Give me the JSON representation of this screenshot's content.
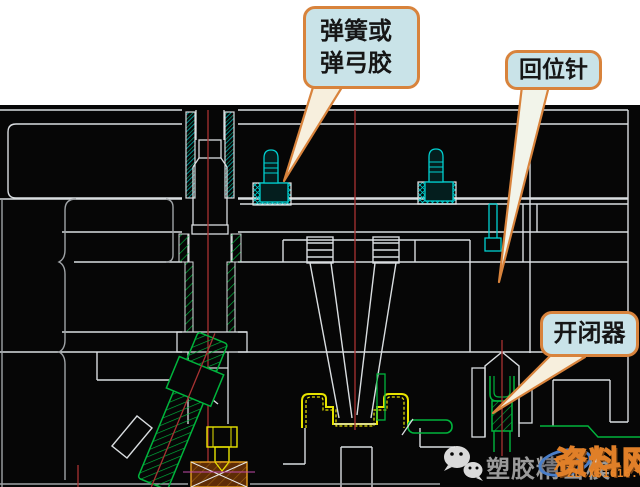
{
  "callouts": {
    "spring": "弹簧或\n弹弓胶",
    "return_pin": "回位针",
    "opener": "开闭器"
  },
  "watermark": {
    "channel_name": "塑胶精密模",
    "logo_text": "XS",
    "site_name": "资料网",
    "site_url": "ZL.XS1616.COM"
  },
  "colors": {
    "callout_fill": "#c9e3e8",
    "callout_border": "#d8833c",
    "cad_background": "#060606",
    "line_white": "#d9dde0",
    "centerline_red": "#a83232",
    "component_cyan": "#00d0d0",
    "component_green": "#00b43c",
    "component_yellow": "#e8e400",
    "watermark_orange": "#e8862a"
  }
}
